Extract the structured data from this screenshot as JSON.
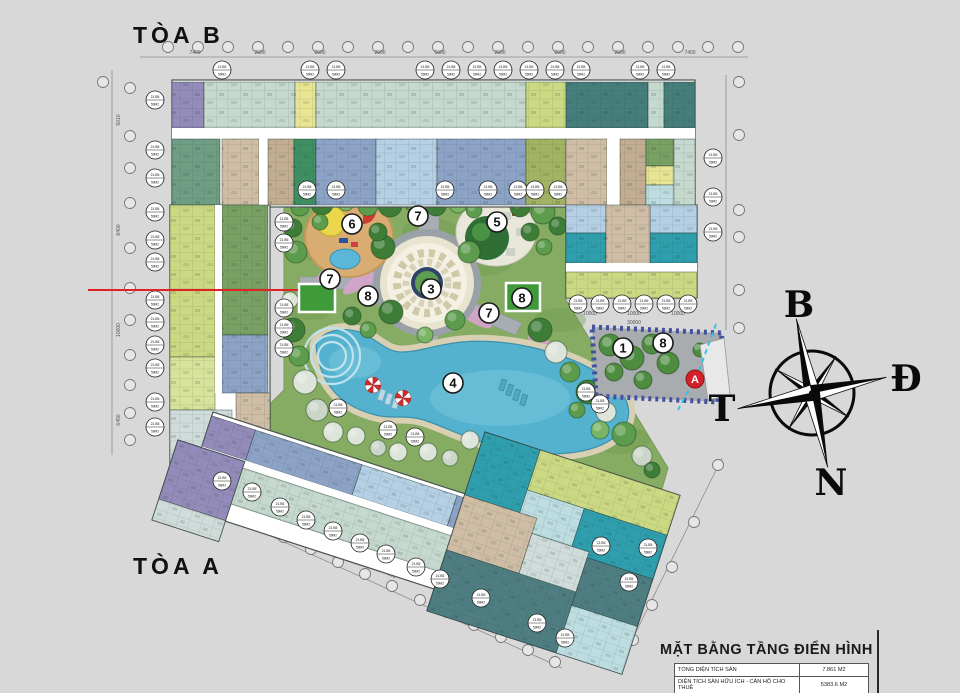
{
  "page": {
    "w": 960,
    "h": 693,
    "bg": "#d8d8d8"
  },
  "labels": {
    "tower_b": "TÒA B",
    "tower_a": "TÒA A"
  },
  "compass": {
    "north": "B",
    "east": "Đ",
    "south": "N",
    "west": "T",
    "cx": 812,
    "cy": 393,
    "r": 42,
    "rot": -12,
    "letter_pos": {
      "north": [
        799,
        305
      ],
      "east": [
        906,
        379
      ],
      "south": [
        831,
        483
      ],
      "west": [
        722,
        409
      ]
    }
  },
  "title_block": {
    "title": "MẶT BẰNG TẦNG ĐIỂN HÌNH",
    "rows": [
      {
        "label": "TỔNG DIỆN TÍCH SÀN",
        "value": "7.861 M2"
      },
      {
        "label": "DIỆN TÍCH SÀN HỮU ÍCH - CĂN HỘ CHO THUÊ",
        "value": "5383.6 M2"
      }
    ]
  },
  "unit_badge": {
    "code": "21.B5",
    "area": "59M2"
  },
  "palette": {
    "sage": "#c6d9ce",
    "sage2": "#d2e2d8",
    "dteal": "#467e7b",
    "purple": "#938bb9",
    "yellow": "#e7e492",
    "ygreen": "#ccd983",
    "ygreen2": "#d8e29a",
    "olive": "#a3b364",
    "dgreen": "#79a163",
    "teal2": "#6f9e85",
    "emerald": "#3f8f63",
    "slate": "#8ca3c6",
    "lblue": "#b5cfe4",
    "cyan": "#2f9fae",
    "lcyan": "#bddde1",
    "steel": "#4f7e82",
    "steel2": "#3f6f74",
    "beige": "#cfbda5",
    "beige2": "#c2ad92",
    "white": "#ffffff",
    "mint": "#cfdcda",
    "grass": "#86ab62",
    "grassdark": "#6d9750",
    "pool": "#55b2cf",
    "poollight": "#7cc8dd",
    "deck": "#d9cfb2",
    "path": "#a7adb2",
    "lawn": "#3f9b3a",
    "pink": "#d6a3cb",
    "sand": "#d9ad72",
    "g1": "#3e7d38",
    "g2": "#5d9c4c",
    "g3": "#79b564",
    "w1": "#dde4da",
    "w2": "#ccd6c8",
    "marker_a_bg": "#d42028",
    "outline": "#4a5450"
  },
  "outlines": [
    [
      172,
      80,
      523,
      127
    ],
    [
      566,
      205,
      131,
      93
    ],
    [
      170,
      205,
      100,
      267
    ]
  ],
  "units_abs": [
    [
      172,
      82,
      32,
      46,
      "purple"
    ],
    [
      204,
      82,
      91,
      46,
      "sage"
    ],
    [
      295,
      82,
      21,
      46,
      "yellow"
    ],
    [
      316,
      82,
      210,
      46,
      "sage"
    ],
    [
      526,
      82,
      40,
      46,
      "ygreen"
    ],
    [
      566,
      82,
      82,
      46,
      "dteal"
    ],
    [
      648,
      82,
      16,
      46,
      "sage"
    ],
    [
      664,
      82,
      31,
      46,
      "dteal"
    ],
    [
      172,
      128,
      523,
      11,
      "white"
    ],
    [
      172,
      139,
      48,
      66,
      "teal2"
    ],
    [
      222,
      139,
      37,
      66,
      "beige"
    ],
    [
      259,
      139,
      9,
      66,
      "white"
    ],
    [
      268,
      139,
      26,
      66,
      "beige2"
    ],
    [
      294,
      139,
      22,
      66,
      "emerald"
    ],
    [
      316,
      139,
      60,
      66,
      "slate"
    ],
    [
      376,
      139,
      61,
      66,
      "lblue"
    ],
    [
      437,
      139,
      89,
      66,
      "slate"
    ],
    [
      526,
      139,
      40,
      66,
      "olive"
    ],
    [
      566,
      139,
      41,
      66,
      "beige"
    ],
    [
      607,
      139,
      13,
      66,
      "white"
    ],
    [
      620,
      139,
      26,
      66,
      "beige2"
    ],
    [
      646,
      139,
      28,
      27,
      "dgreen"
    ],
    [
      646,
      166,
      28,
      19,
      "yellow"
    ],
    [
      646,
      185,
      28,
      20,
      "lcyan"
    ],
    [
      674,
      139,
      21,
      66,
      "sage"
    ],
    [
      566,
      205,
      40,
      28,
      "lblue"
    ],
    [
      650,
      205,
      47,
      28,
      "lblue"
    ],
    [
      566,
      233,
      40,
      30,
      "cyan"
    ],
    [
      650,
      233,
      47,
      30,
      "cyan"
    ],
    [
      606,
      205,
      44,
      60,
      "beige"
    ],
    [
      566,
      263,
      131,
      9,
      "white"
    ],
    [
      566,
      272,
      131,
      26,
      "ygreen"
    ],
    [
      170,
      205,
      45,
      152,
      "ygreen"
    ],
    [
      170,
      357,
      45,
      53,
      "ygreen2"
    ],
    [
      222,
      205,
      46,
      130,
      "dgreen"
    ],
    [
      222,
      335,
      46,
      58,
      "slate"
    ],
    [
      236,
      393,
      34,
      40,
      "beige"
    ],
    [
      170,
      410,
      62,
      62,
      "mint"
    ],
    [
      215,
      205,
      7,
      188,
      "white"
    ]
  ],
  "units_bar": {
    "t": [
      213,
      412
    ],
    "rot": 18,
    "outline": [
      0,
      0,
      352,
      100
    ],
    "rects": [
      [
        0,
        4,
        46,
        32,
        "purple"
      ],
      [
        46,
        4,
        112,
        32,
        "slate"
      ],
      [
        158,
        4,
        100,
        32,
        "lblue"
      ],
      [
        258,
        4,
        94,
        32,
        "slate"
      ],
      [
        0,
        36,
        352,
        8,
        "white"
      ],
      [
        0,
        44,
        352,
        38,
        "sage"
      ]
    ]
  },
  "units_block": {
    "t": [
      485,
      432
    ],
    "rot": 18,
    "outline": [
      0,
      0,
      205,
      188
    ],
    "rects": [
      [
        58,
        0,
        147,
        42,
        "ygreen"
      ],
      [
        0,
        0,
        58,
        66,
        "cyan"
      ],
      [
        58,
        42,
        60,
        40,
        "lcyan"
      ],
      [
        118,
        42,
        87,
        46,
        "cyan"
      ],
      [
        0,
        66,
        76,
        58,
        "beige"
      ],
      [
        76,
        82,
        60,
        52,
        "mint"
      ],
      [
        136,
        88,
        69,
        50,
        "steel"
      ],
      [
        0,
        124,
        136,
        64,
        "steel"
      ],
      [
        136,
        138,
        69,
        50,
        "lcyan"
      ]
    ]
  },
  "units_cap": {
    "t": [
      178,
      440
    ],
    "rot": 18,
    "outline": [
      0,
      0,
      70,
      84
    ],
    "rects": [
      [
        0,
        0,
        70,
        62,
        "purple"
      ],
      [
        0,
        62,
        70,
        22,
        "mint"
      ]
    ]
  },
  "courtyard_poly": "284,197 566,197 566,300 668,468 662,489 485,432 465,494 250,424 284,390",
  "grass_tex": [
    [
      330,
      250,
      30,
      14
    ],
    [
      480,
      260,
      34,
      16
    ],
    [
      380,
      360,
      40,
      18
    ],
    [
      560,
      320,
      26,
      12
    ],
    [
      620,
      440,
      30,
      14
    ],
    [
      310,
      310,
      22,
      10
    ],
    [
      520,
      420,
      36,
      16
    ],
    [
      430,
      230,
      28,
      12
    ]
  ],
  "paths": [
    {
      "d": "M290,196 h272 v8 h-272 z"
    },
    {
      "d": "M419,196 h20 v40 h-20 z"
    },
    {
      "d": "M352,262 l42,22 -8,13 -42,-22 z"
    },
    {
      "d": "M458,296 l64,27 -7,12 -64,-27 z"
    },
    {
      "d": "M300,277 h78 v12 h-78 z"
    },
    {
      "d": "M420,335 h18 v20 h-18 z"
    }
  ],
  "flowers": [
    [
      408,
      198,
      16,
      6,
      0
    ],
    [
      368,
      276,
      30,
      8,
      -35
    ],
    [
      470,
      312,
      26,
      8,
      35
    ],
    [
      545,
      347,
      20,
      7,
      35
    ],
    [
      332,
      270,
      18,
      6,
      -35
    ]
  ],
  "plaza": {
    "cx": 427,
    "cy": 283,
    "r_walk": 54,
    "r_ring": 47,
    "r_mosaic": 40,
    "r_navy": 16,
    "r_green": 12
  },
  "playground": {
    "cx": 349,
    "cy": 237,
    "rx": 44,
    "ry": 40,
    "dome": [
      331,
      221,
      15
    ],
    "red": [
      363,
      211,
      13
    ],
    "pond": [
      345,
      259,
      15,
      10
    ]
  },
  "garden5": {
    "cx": 496,
    "cy": 232,
    "rx": 40,
    "ry": 34,
    "tree": [
      487,
      238,
      22
    ]
  },
  "pool": {
    "d": "M316,345 C322,330 344,326 362,333 C378,340 386,352 402,352 C420,352 438,344 462,342 C510,338 568,352 606,378 C632,396 636,420 616,436 C592,456 544,458 504,448 C468,440 448,428 424,420 C404,414 390,420 372,414 C344,406 320,388 316,345 Z",
    "steps_c": [
      332,
      356
    ],
    "step_radii": [
      14,
      21,
      28
    ]
  },
  "furniture": {
    "umbrellas": [
      [
        373,
        385
      ],
      [
        403,
        398
      ]
    ],
    "chairs_light": [
      [
        381,
        389
      ],
      [
        388,
        393
      ],
      [
        395,
        397
      ]
    ],
    "chairs_teal": [
      [
        502,
        379
      ],
      [
        509,
        384
      ],
      [
        516,
        389
      ],
      [
        523,
        394
      ]
    ]
  },
  "lawns": [
    [
      299,
      284,
      36,
      28
    ],
    [
      506,
      283,
      34,
      28
    ],
    [
      650,
      332,
      26,
      20
    ]
  ],
  "trees": [
    [
      300,
      207,
      9,
      "g2"
    ],
    [
      322,
      204,
      11,
      "g1"
    ],
    [
      346,
      203,
      8,
      "g3"
    ],
    [
      368,
      206,
      10,
      "g2"
    ],
    [
      390,
      205,
      12,
      "g1"
    ],
    [
      412,
      203,
      8,
      "g2"
    ],
    [
      436,
      206,
      10,
      "g1"
    ],
    [
      458,
      204,
      9,
      "g3"
    ],
    [
      474,
      210,
      8,
      "g2"
    ],
    [
      520,
      207,
      10,
      "g1"
    ],
    [
      543,
      212,
      12,
      "g2"
    ],
    [
      558,
      226,
      9,
      "g1"
    ],
    [
      293,
      228,
      9,
      "g1"
    ],
    [
      296,
      252,
      11,
      "g2"
    ],
    [
      290,
      300,
      8,
      "w1"
    ],
    [
      293,
      330,
      12,
      "g1"
    ],
    [
      299,
      356,
      10,
      "g2"
    ],
    [
      305,
      382,
      12,
      "w1"
    ],
    [
      317,
      410,
      11,
      "w2"
    ],
    [
      333,
      432,
      10,
      "w1"
    ],
    [
      383,
      247,
      12,
      "g1"
    ],
    [
      469,
      252,
      11,
      "g2"
    ],
    [
      391,
      312,
      12,
      "g1"
    ],
    [
      455,
      320,
      10,
      "g2"
    ],
    [
      425,
      335,
      8,
      "g3"
    ],
    [
      320,
      222,
      8,
      "g2"
    ],
    [
      378,
      232,
      9,
      "g1"
    ],
    [
      530,
      232,
      9,
      "g1"
    ],
    [
      544,
      247,
      8,
      "g2"
    ],
    [
      540,
      330,
      12,
      "g1"
    ],
    [
      556,
      352,
      11,
      "w1"
    ],
    [
      570,
      372,
      10,
      "g2"
    ],
    [
      588,
      392,
      12,
      "g1"
    ],
    [
      606,
      412,
      10,
      "w1"
    ],
    [
      624,
      434,
      12,
      "g2"
    ],
    [
      642,
      456,
      10,
      "w2"
    ],
    [
      652,
      470,
      8,
      "g1"
    ],
    [
      600,
      430,
      9,
      "g3"
    ],
    [
      577,
      410,
      8,
      "g2"
    ],
    [
      352,
      316,
      9,
      "g1"
    ],
    [
      368,
      330,
      8,
      "g2"
    ],
    [
      356,
      436,
      9,
      "w1"
    ],
    [
      378,
      448,
      8,
      "w2"
    ],
    [
      398,
      452,
      9,
      "w1"
    ],
    [
      470,
      440,
      9,
      "w1"
    ],
    [
      494,
      448,
      8,
      "w2"
    ],
    [
      428,
      452,
      9,
      "w1"
    ],
    [
      450,
      458,
      8,
      "w2"
    ],
    [
      520,
      455,
      9,
      "w1"
    ],
    [
      545,
      462,
      8,
      "g2"
    ]
  ],
  "block": {
    "poly": "592,327 722,333 718,402 596,396",
    "trees": [
      [
        610,
        345,
        11
      ],
      [
        632,
        358,
        12
      ],
      [
        652,
        344,
        10
      ],
      [
        614,
        372,
        9
      ],
      [
        668,
        363,
        11
      ],
      [
        643,
        380,
        9
      ],
      [
        700,
        350,
        7
      ]
    ],
    "ramp_poly": "700,345 724,338 730,395 708,400",
    "ramp_line": "716,324 700,368 678,410"
  },
  "markers": [
    {
      "n": "1",
      "x": 623,
      "y": 348
    },
    {
      "n": "3",
      "x": 431,
      "y": 289
    },
    {
      "n": "4",
      "x": 453,
      "y": 383
    },
    {
      "n": "5",
      "x": 497,
      "y": 222
    },
    {
      "n": "6",
      "x": 352,
      "y": 224
    },
    {
      "n": "7",
      "x": 418,
      "y": 216
    },
    {
      "n": "7",
      "x": 330,
      "y": 279
    },
    {
      "n": "7",
      "x": 489,
      "y": 313
    },
    {
      "n": "8",
      "x": 368,
      "y": 296
    },
    {
      "n": "8",
      "x": 522,
      "y": 298
    },
    {
      "n": "8",
      "x": 663,
      "y": 343
    }
  ],
  "marker_a": {
    "letter": "A",
    "x": 695,
    "y": 379
  },
  "badges": [
    [
      222,
      70
    ],
    [
      310,
      70
    ],
    [
      336,
      70
    ],
    [
      425,
      70
    ],
    [
      451,
      70
    ],
    [
      477,
      70
    ],
    [
      503,
      70
    ],
    [
      529,
      70
    ],
    [
      555,
      70
    ],
    [
      581,
      70
    ],
    [
      640,
      70
    ],
    [
      666,
      70
    ],
    [
      307,
      190
    ],
    [
      336,
      190
    ],
    [
      445,
      190
    ],
    [
      488,
      190
    ],
    [
      518,
      190
    ],
    [
      535,
      190
    ],
    [
      558,
      190
    ],
    [
      155,
      100
    ],
    [
      155,
      150
    ],
    [
      155,
      178
    ],
    [
      155,
      212
    ],
    [
      155,
      240
    ],
    [
      155,
      262
    ],
    [
      155,
      300
    ],
    [
      155,
      322
    ],
    [
      155,
      345
    ],
    [
      155,
      368
    ],
    [
      155,
      402
    ],
    [
      155,
      427
    ],
    [
      284,
      222
    ],
    [
      284,
      243
    ],
    [
      284,
      308
    ],
    [
      284,
      328
    ],
    [
      284,
      348
    ],
    [
      713,
      158
    ],
    [
      713,
      197
    ],
    [
      713,
      232
    ],
    [
      578,
      304
    ],
    [
      600,
      304
    ],
    [
      622,
      304
    ],
    [
      644,
      304
    ],
    [
      666,
      304
    ],
    [
      688,
      304
    ],
    [
      338,
      408
    ],
    [
      388,
      430
    ],
    [
      415,
      437
    ],
    [
      222,
      481
    ],
    [
      252,
      492
    ],
    [
      280,
      507
    ],
    [
      306,
      520
    ],
    [
      333,
      531
    ],
    [
      360,
      543
    ],
    [
      386,
      554
    ],
    [
      416,
      567
    ],
    [
      440,
      579
    ],
    [
      481,
      598
    ],
    [
      537,
      623
    ],
    [
      565,
      638
    ],
    [
      648,
      548
    ],
    [
      629,
      582
    ],
    [
      601,
      546
    ],
    [
      586,
      392
    ],
    [
      600,
      404
    ]
  ],
  "bubbles": [
    [
      168,
      47
    ],
    [
      198,
      47
    ],
    [
      228,
      47
    ],
    [
      258,
      47
    ],
    [
      288,
      47
    ],
    [
      318,
      47
    ],
    [
      348,
      47
    ],
    [
      378,
      47
    ],
    [
      408,
      47
    ],
    [
      438,
      47
    ],
    [
      468,
      47
    ],
    [
      498,
      47
    ],
    [
      528,
      47
    ],
    [
      558,
      47
    ],
    [
      588,
      47
    ],
    [
      618,
      47
    ],
    [
      648,
      47
    ],
    [
      678,
      47
    ],
    [
      708,
      47
    ],
    [
      738,
      47
    ],
    [
      103,
      82
    ],
    [
      130,
      88
    ],
    [
      130,
      136
    ],
    [
      130,
      168
    ],
    [
      130,
      203
    ],
    [
      130,
      248
    ],
    [
      130,
      288
    ],
    [
      130,
      320
    ],
    [
      130,
      355
    ],
    [
      130,
      385
    ],
    [
      130,
      413
    ],
    [
      130,
      440
    ],
    [
      739,
      82
    ],
    [
      739,
      135
    ],
    [
      739,
      210
    ],
    [
      739,
      237
    ],
    [
      739,
      290
    ],
    [
      739,
      328
    ],
    [
      203,
      498
    ],
    [
      230,
      511
    ],
    [
      257,
      524
    ],
    [
      284,
      537
    ],
    [
      311,
      549
    ],
    [
      338,
      562
    ],
    [
      365,
      574
    ],
    [
      392,
      586
    ],
    [
      420,
      600
    ],
    [
      447,
      612
    ],
    [
      474,
      625
    ],
    [
      501,
      637
    ],
    [
      528,
      650
    ],
    [
      555,
      662
    ],
    [
      718,
      465
    ],
    [
      694,
      522
    ],
    [
      672,
      567
    ],
    [
      652,
      605
    ],
    [
      633,
      640
    ]
  ],
  "dimlines": [
    [
      140,
      57,
      748,
      57
    ],
    [
      112,
      70,
      112,
      455
    ],
    [
      726,
      75,
      726,
      330
    ],
    [
      196,
      502,
      562,
      668
    ],
    [
      722,
      458,
      628,
      648
    ]
  ],
  "dims": {
    "top": {
      "y": 54,
      "items": [
        [
          195,
          "7400"
        ],
        [
          260,
          "2000"
        ],
        [
          320,
          "2000"
        ],
        [
          380,
          "2000"
        ],
        [
          440,
          "5000"
        ],
        [
          500,
          "2000"
        ],
        [
          560,
          "2000"
        ],
        [
          620,
          "2000"
        ],
        [
          690,
          "7400"
        ]
      ]
    },
    "left": {
      "x": 120,
      "items": [
        [
          120,
          "5010"
        ],
        [
          230,
          "8400"
        ],
        [
          330,
          "10000"
        ],
        [
          420,
          "6450"
        ]
      ]
    },
    "right_wing": {
      "y": 315,
      "items": [
        [
          590,
          "10000"
        ],
        [
          634,
          "10000"
        ],
        [
          678,
          "10000"
        ]
      ],
      "total": [
        634,
        324,
        "30000"
      ]
    },
    "diag": {
      "rot": 25,
      "items": [
        [
          250,
          520,
          "5000"
        ],
        [
          320,
          548,
          "5000"
        ],
        [
          390,
          576,
          "5000"
        ],
        [
          460,
          604,
          "5000"
        ],
        [
          530,
          632,
          "5000"
        ]
      ]
    }
  },
  "red_line": [
    88,
    289,
    210
  ],
  "frame_line": [
    877,
    630,
    63
  ]
}
